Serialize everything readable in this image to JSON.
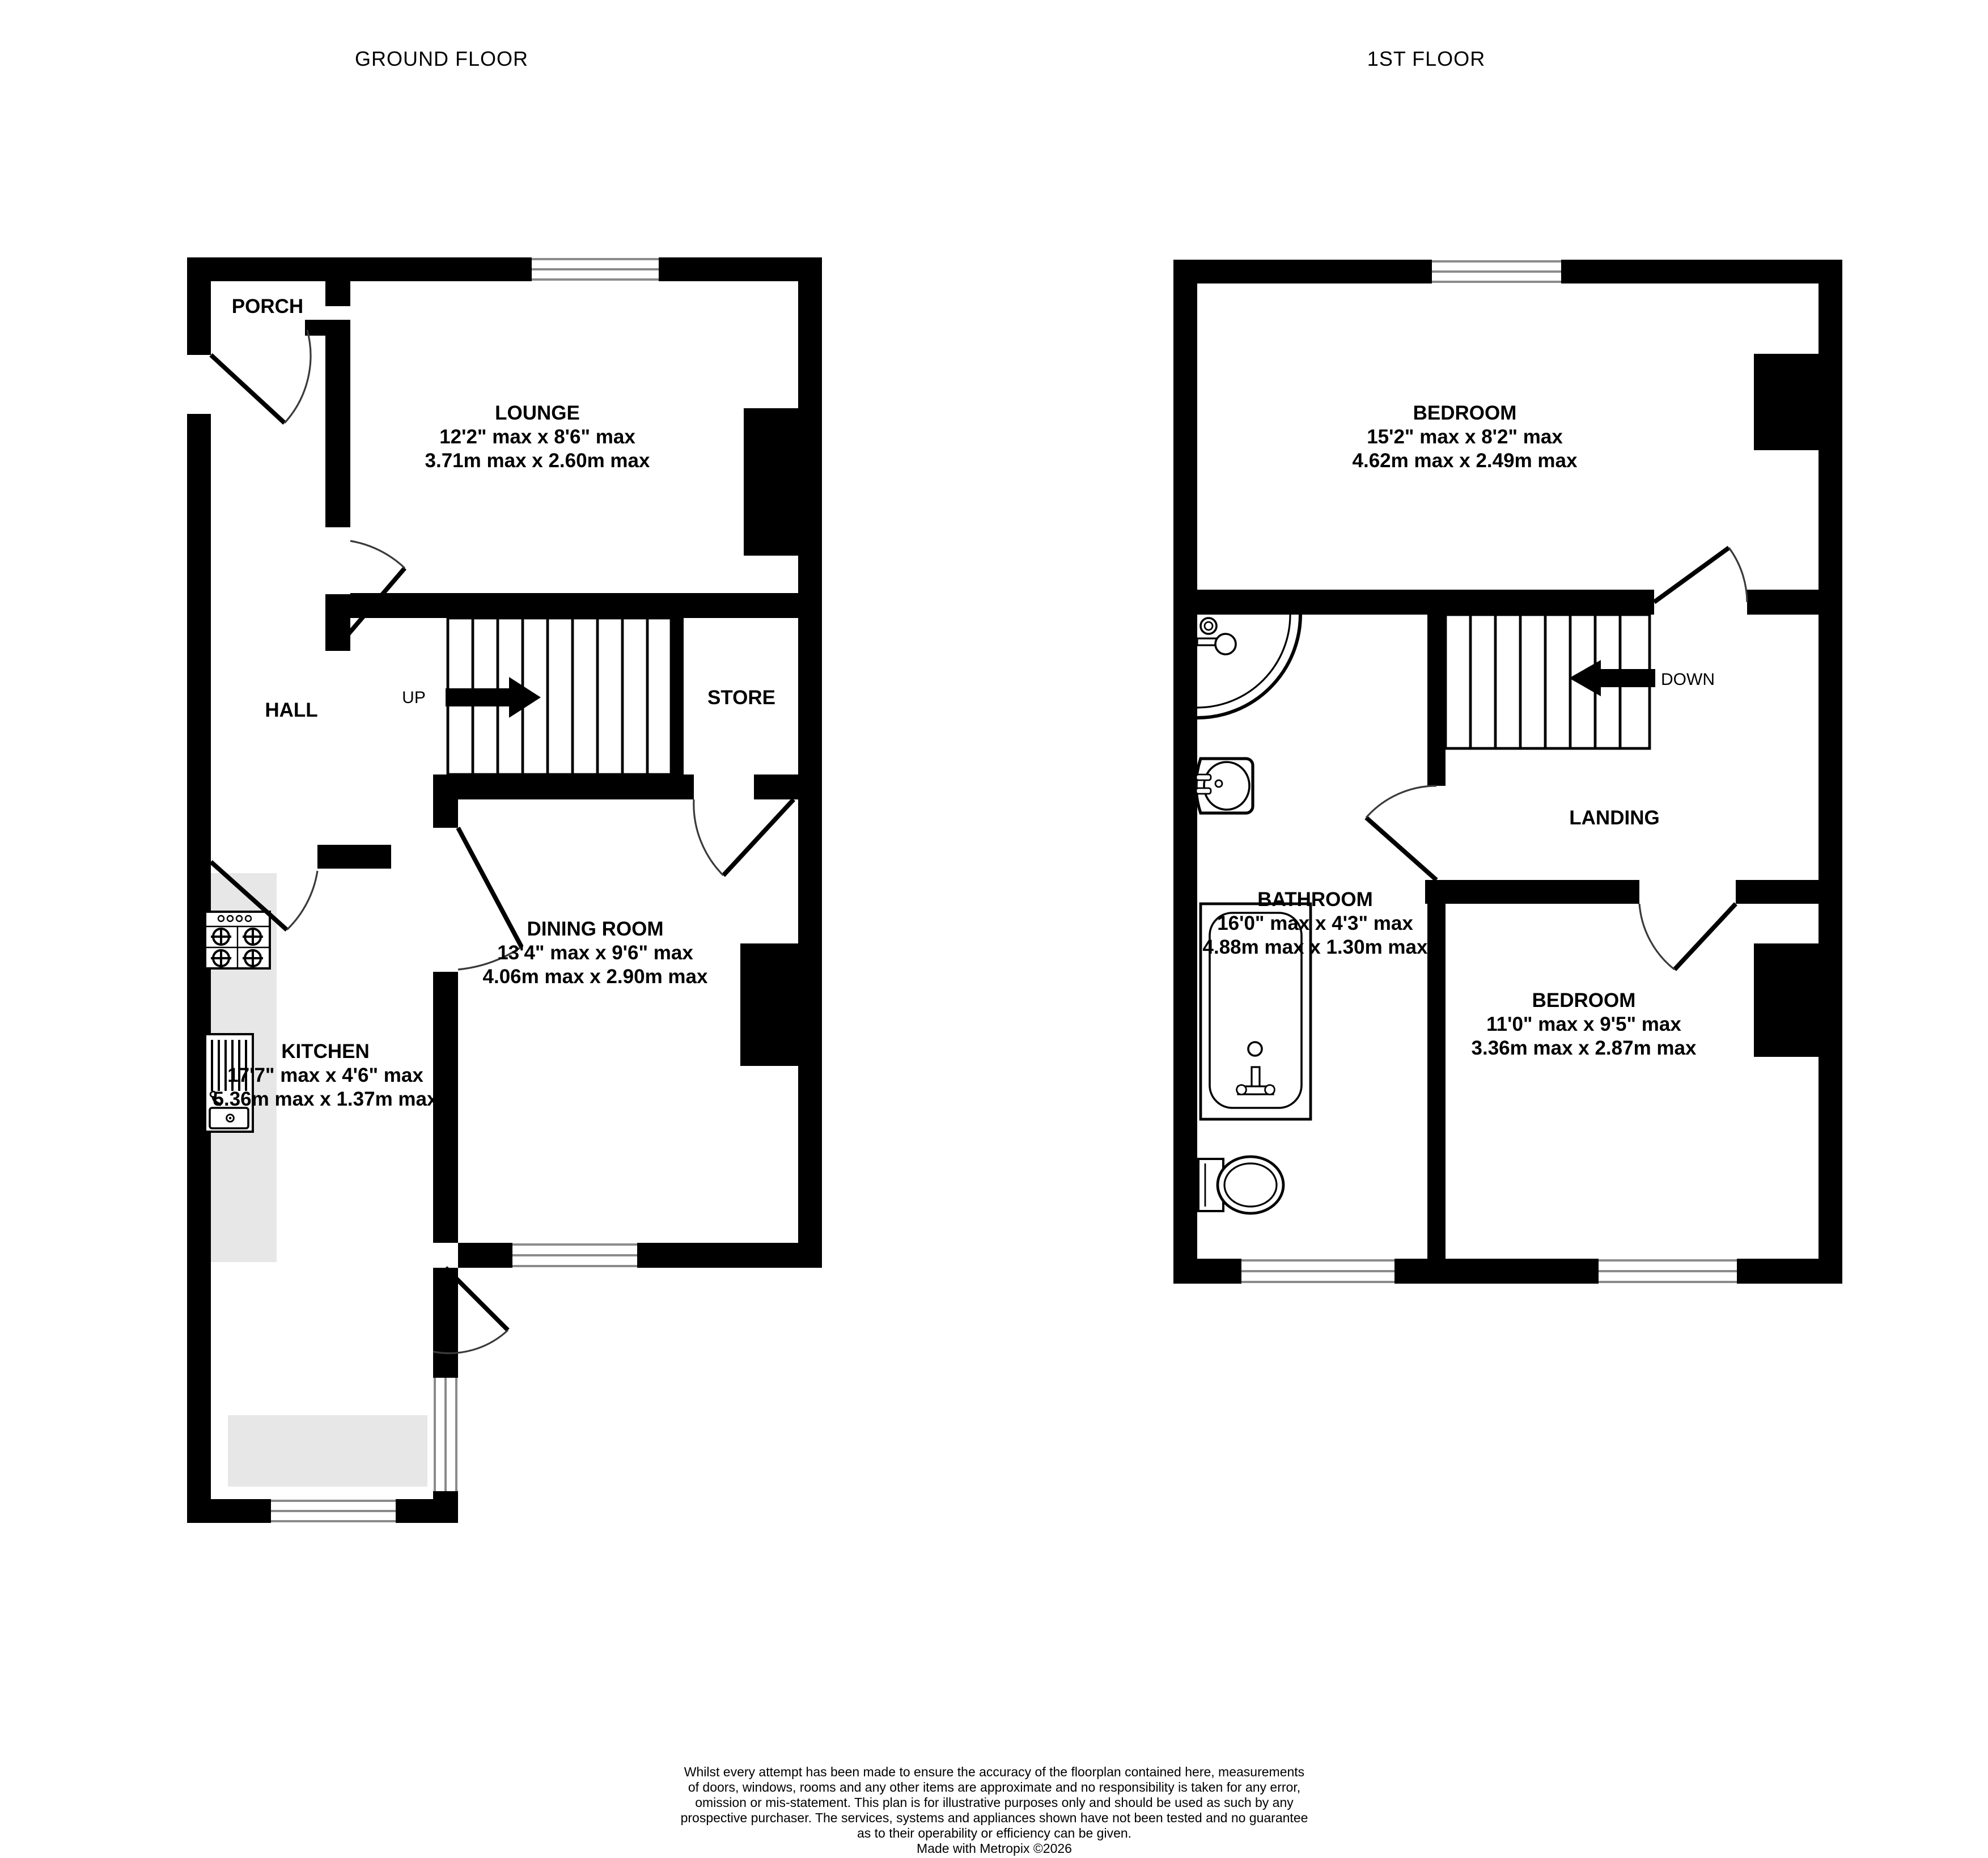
{
  "ground": {
    "title": "GROUND FLOOR",
    "up_label": "UP",
    "rooms": {
      "porch": {
        "name": "PORCH"
      },
      "lounge": {
        "name": "LOUNGE",
        "imperial": "12'2\" max x 8'6\" max",
        "metric": "3.71m max x 2.60m max"
      },
      "hall": {
        "name": "HALL"
      },
      "store": {
        "name": "STORE"
      },
      "dining": {
        "name": "DINING ROOM",
        "imperial": "13'4\" max x 9'6\" max",
        "metric": "4.06m max x 2.90m max"
      },
      "kitchen": {
        "name": "KITCHEN",
        "imperial": "17'7\" max x 4'6\" max",
        "metric": "5.36m max x 1.37m max"
      }
    }
  },
  "first": {
    "title": "1ST FLOOR",
    "down_label": "DOWN",
    "rooms": {
      "bedroom1": {
        "name": "BEDROOM",
        "imperial": "15'2\" max x 8'2\" max",
        "metric": "4.62m max x 2.49m max"
      },
      "bathroom": {
        "name": "BATHROOM",
        "imperial": "16'0\" max x 4'3\" max",
        "metric": "4.88m max x 1.30m max"
      },
      "landing": {
        "name": "LANDING"
      },
      "bedroom2": {
        "name": "BEDROOM",
        "imperial": "11'0\" max x 9'5\" max",
        "metric": "3.36m max x 2.87m max"
      }
    }
  },
  "footer": {
    "lines": [
      "Whilst every attempt has been made to ensure the accuracy of the floorplan contained here, measurements",
      "of doors, windows, rooms and any other items are approximate and no responsibility is taken for any error,",
      "omission or mis-statement. This plan is for illustrative purposes only and should be used as such by any",
      "prospective purchaser. The services, systems and appliances shown have not been tested and no guarantee",
      "as to their operability or efficiency can be given.",
      "Made with Metropix ©2026"
    ]
  },
  "colors": {
    "wall": "#000000",
    "counter": "#e7e7e7",
    "window_line": "#8a8a8a"
  }
}
